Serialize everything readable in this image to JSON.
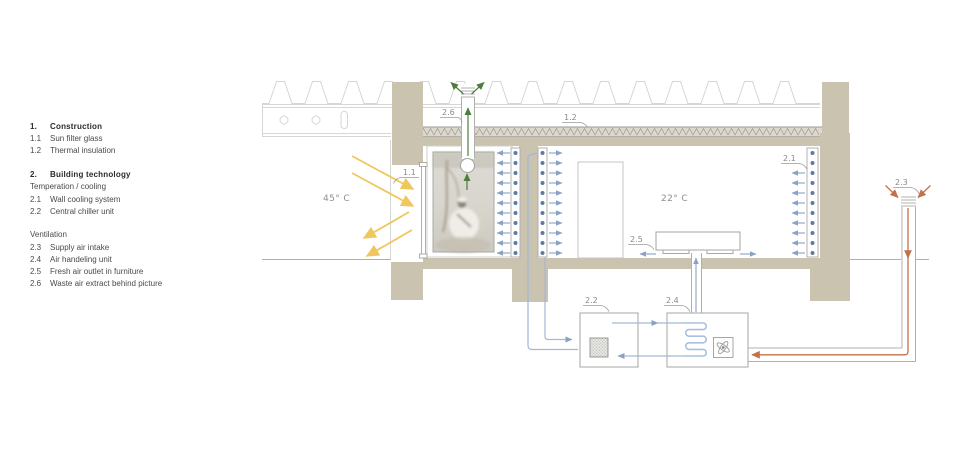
{
  "legend": {
    "rows": [
      {
        "num": "1.",
        "label": "Construction"
      },
      {
        "num": "1.1",
        "label": "Sun filter glass"
      },
      {
        "num": "1.2",
        "label": "Thermal insulation"
      },
      {
        "num": "2.",
        "label": "Building technology"
      },
      {
        "num": "",
        "label": "Temperation / cooling"
      },
      {
        "num": "2.1",
        "label": "Wall cooling system"
      },
      {
        "num": "2.2",
        "label": "Central chiller unit"
      },
      {
        "num": "",
        "label": "Ventilation"
      },
      {
        "num": "2.3",
        "label": "Supply air intake"
      },
      {
        "num": "2.4",
        "label": "Air handeling unit"
      },
      {
        "num": "2.5",
        "label": "Fresh air outlet in furniture"
      },
      {
        "num": "2.6",
        "label": "Waste air extract behind picture"
      }
    ]
  },
  "diagram": {
    "outside_temp": "45° C",
    "inside_temp": "22° C",
    "callouts": {
      "c11": "1.1",
      "c12": "1.2",
      "c21": "2.1",
      "c22": "2.2",
      "c23": "2.3",
      "c24": "2.4",
      "c25": "2.5",
      "c26": "2.6"
    }
  },
  "colors": {
    "tan": "#c9c3af",
    "insulation-bg": "#ddd8cb",
    "blue": "#8aa2c4",
    "pipe-blue": "#a3b8d6",
    "dot-blue": "#5f7aa3",
    "green": "#4d7c3f",
    "yellow": "#f0c75e",
    "orange": "#c2714b",
    "line-gray": "#b0b0ad",
    "light-gray": "#d6d6d3",
    "label-gray": "#8a8a88"
  }
}
